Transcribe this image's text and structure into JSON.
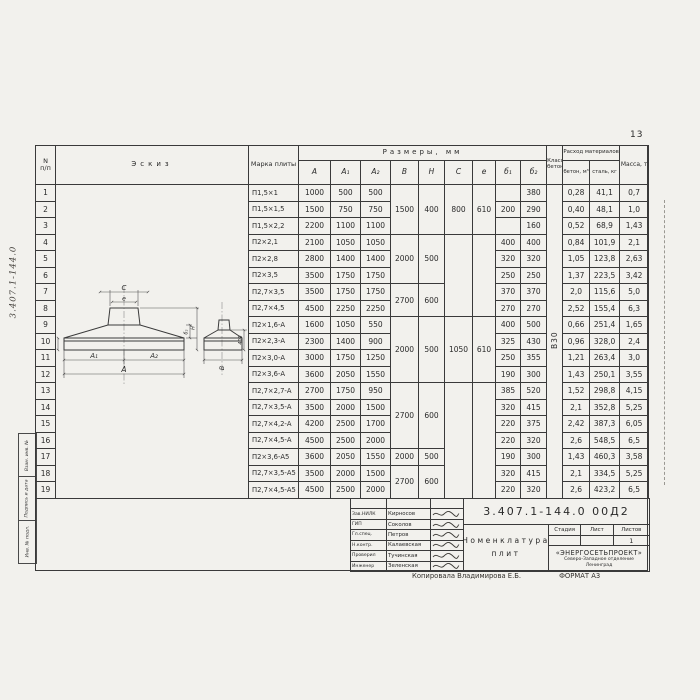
{
  "page": {
    "sheet_number": "13",
    "margin_doc_number": "3.407.1-144.0",
    "margin_stamps": [
      "Взам. инв. №",
      "Подпись и дата",
      "Инв. № подл."
    ],
    "copy_line": {
      "copied_by": "Копировала Владимирова Е.Б.",
      "format": "ФОРМАТ А3"
    }
  },
  "table": {
    "headers": {
      "num_top": "N",
      "num_bottom": "п/п",
      "sketch": "Эскиз",
      "mark": "Марка плиты",
      "dims_group": "Размеры,  мм",
      "dims": [
        "A",
        "A₁",
        "A₂",
        "B",
        "H",
        "C",
        "e",
        "б₁",
        "б₂"
      ],
      "concrete_class": "Класс бетона",
      "consumption_group": "Расход материалов",
      "consumption": [
        "бетон, м³",
        "сталь, кг"
      ],
      "mass": "Масса, т"
    },
    "concrete_class_value": "В30",
    "rows": [
      {
        "n": "1",
        "mark": "П1,5×1",
        "a": "1000",
        "a1": "500",
        "a2": "500",
        "b1": "",
        "b2": "380",
        "concrete": "0,28",
        "steel": "41,1",
        "mass": "0,7"
      },
      {
        "n": "2",
        "mark": "П1,5×1,5",
        "a": "1500",
        "a1": "750",
        "a2": "750",
        "b1": "200",
        "b2": "290",
        "concrete": "0,40",
        "steel": "48,1",
        "mass": "1,0"
      },
      {
        "n": "3",
        "mark": "П1,5×2,2",
        "a": "2200",
        "a1": "1100",
        "a2": "1100",
        "b1": "",
        "b2": "160",
        "concrete": "0,52",
        "steel": "68,9",
        "mass": "1,43"
      },
      {
        "n": "4",
        "mark": "П2×2,1",
        "a": "2100",
        "a1": "1050",
        "a2": "1050",
        "b1": "400",
        "b2": "400",
        "concrete": "0,84",
        "steel": "101,9",
        "mass": "2,1"
      },
      {
        "n": "5",
        "mark": "П2×2,8",
        "a": "2800",
        "a1": "1400",
        "a2": "1400",
        "b1": "320",
        "b2": "320",
        "concrete": "1,05",
        "steel": "123,8",
        "mass": "2,63"
      },
      {
        "n": "6",
        "mark": "П2×3,5",
        "a": "3500",
        "a1": "1750",
        "a2": "1750",
        "b1": "250",
        "b2": "250",
        "concrete": "1,37",
        "steel": "223,5",
        "mass": "3,42"
      },
      {
        "n": "7",
        "mark": "П2,7×3,5",
        "a": "3500",
        "a1": "1750",
        "a2": "1750",
        "b1": "370",
        "b2": "370",
        "concrete": "2,0",
        "steel": "115,6",
        "mass": "5,0"
      },
      {
        "n": "8",
        "mark": "П2,7×4,5",
        "a": "4500",
        "a1": "2250",
        "a2": "2250",
        "b1": "270",
        "b2": "270",
        "concrete": "2,52",
        "steel": "155,4",
        "mass": "6,3"
      },
      {
        "n": "9",
        "mark": "П2×1,6-А",
        "a": "1600",
        "a1": "1050",
        "a2": "550",
        "b1": "400",
        "b2": "500",
        "concrete": "0,66",
        "steel": "251,4",
        "mass": "1,65"
      },
      {
        "n": "10",
        "mark": "П2×2,3-А",
        "a": "2300",
        "a1": "1400",
        "a2": "900",
        "b1": "325",
        "b2": "430",
        "concrete": "0,96",
        "steel": "328,0",
        "mass": "2,4"
      },
      {
        "n": "11",
        "mark": "П2×3,0-А",
        "a": "3000",
        "a1": "1750",
        "a2": "1250",
        "b1": "250",
        "b2": "355",
        "concrete": "1,21",
        "steel": "263,4",
        "mass": "3,0"
      },
      {
        "n": "12",
        "mark": "П2×3,6-А",
        "a": "3600",
        "a1": "2050",
        "a2": "1550",
        "b1": "190",
        "b2": "300",
        "concrete": "1,43",
        "steel": "250,1",
        "mass": "3,55"
      },
      {
        "n": "13",
        "mark": "П2,7×2,7-А",
        "a": "2700",
        "a1": "1750",
        "a2": "950",
        "b1": "385",
        "b2": "520",
        "concrete": "1,52",
        "steel": "298,8",
        "mass": "4,15"
      },
      {
        "n": "14",
        "mark": "П2,7×3,5-А",
        "a": "3500",
        "a1": "2000",
        "a2": "1500",
        "b1": "320",
        "b2": "415",
        "concrete": "2,1",
        "steel": "352,8",
        "mass": "5,25"
      },
      {
        "n": "15",
        "mark": "П2,7×4,2-А",
        "a": "4200",
        "a1": "2500",
        "a2": "1700",
        "b1": "220",
        "b2": "375",
        "concrete": "2,42",
        "steel": "387,3",
        "mass": "6,05"
      },
      {
        "n": "16",
        "mark": "П2,7×4,5-А",
        "a": "4500",
        "a1": "2500",
        "a2": "2000",
        "b1": "220",
        "b2": "320",
        "concrete": "2,6",
        "steel": "548,5",
        "mass": "6,5"
      },
      {
        "n": "17",
        "mark": "П2×3,6-А5",
        "a": "3600",
        "a1": "2050",
        "a2": "1550",
        "b1": "190",
        "b2": "300",
        "concrete": "1,43",
        "steel": "460,3",
        "mass": "3,58"
      },
      {
        "n": "18",
        "mark": "П2,7×3,5-А5",
        "a": "3500",
        "a1": "2000",
        "a2": "1500",
        "b1": "320",
        "b2": "415",
        "concrete": "2,1",
        "steel": "334,5",
        "mass": "5,25"
      },
      {
        "n": "19",
        "mark": "П2,7×4,5-А5",
        "a": "4500",
        "a1": "2500",
        "a2": "2000",
        "b1": "220",
        "b2": "320",
        "concrete": "2,6",
        "steel": "423,2",
        "mass": "6,5"
      }
    ],
    "bh_merges": [
      {
        "from": 1,
        "to": 3,
        "b": "1500",
        "h": "400"
      },
      {
        "from": 4,
        "to": 6,
        "b": "2000",
        "h": "500"
      },
      {
        "from": 7,
        "to": 8,
        "b": "2700",
        "h": "600"
      },
      {
        "from": 9,
        "to": 12,
        "b": "2000",
        "h": "500"
      },
      {
        "from": 13,
        "to": 16,
        "b": "2700",
        "h": "600"
      },
      {
        "from": 17,
        "to": 17,
        "b": "2000",
        "h": "500"
      },
      {
        "from": 18,
        "to": 19,
        "b": "2700",
        "h": "600"
      }
    ],
    "c_merges": [
      {
        "from": 1,
        "to": 3,
        "v": "800"
      },
      {
        "from": 4,
        "to": 8,
        "v": ""
      },
      {
        "from": 9,
        "to": 12,
        "v": "1050"
      },
      {
        "from": 13,
        "to": 19,
        "v": ""
      }
    ],
    "e_merges": [
      {
        "from": 1,
        "to": 3,
        "v": "610"
      },
      {
        "from": 4,
        "to": 8,
        "v": ""
      },
      {
        "from": 9,
        "to": 12,
        "v": "610"
      },
      {
        "from": 13,
        "to": 19,
        "v": ""
      }
    ]
  },
  "sketch": {
    "labels": {
      "c": "C",
      "e": "e",
      "a1": "A₁",
      "a2": "A₂",
      "a": "A",
      "b": "B",
      "b1": "б₁",
      "b2": "б₂",
      "h": "H",
      "h_right": "400"
    }
  },
  "title_block": {
    "doc_number": "3.407.1-144.0  00Д2",
    "title_line1": "Номенклатура",
    "title_line2": "плит",
    "stage_headers": [
      "Стадия",
      "Лист",
      "Листов"
    ],
    "sheets_value": "1",
    "org_name": "«ЭНЕРГОСЕТЬПРОЕКТ»",
    "org_branch": "Северо-Западное отделение",
    "org_city": "Ленинград",
    "people": [
      {
        "role": "Зав.НИЛК",
        "name": "Кирносов"
      },
      {
        "role": "ГИП",
        "name": "Соколов"
      },
      {
        "role": "Гл.спец.",
        "name": "Петров"
      },
      {
        "role": "Н.контр.",
        "name": "Калаевская"
      },
      {
        "role": "Проверил",
        "name": "Тучинская"
      },
      {
        "role": "Инженер",
        "name": "Зеленская"
      }
    ]
  }
}
